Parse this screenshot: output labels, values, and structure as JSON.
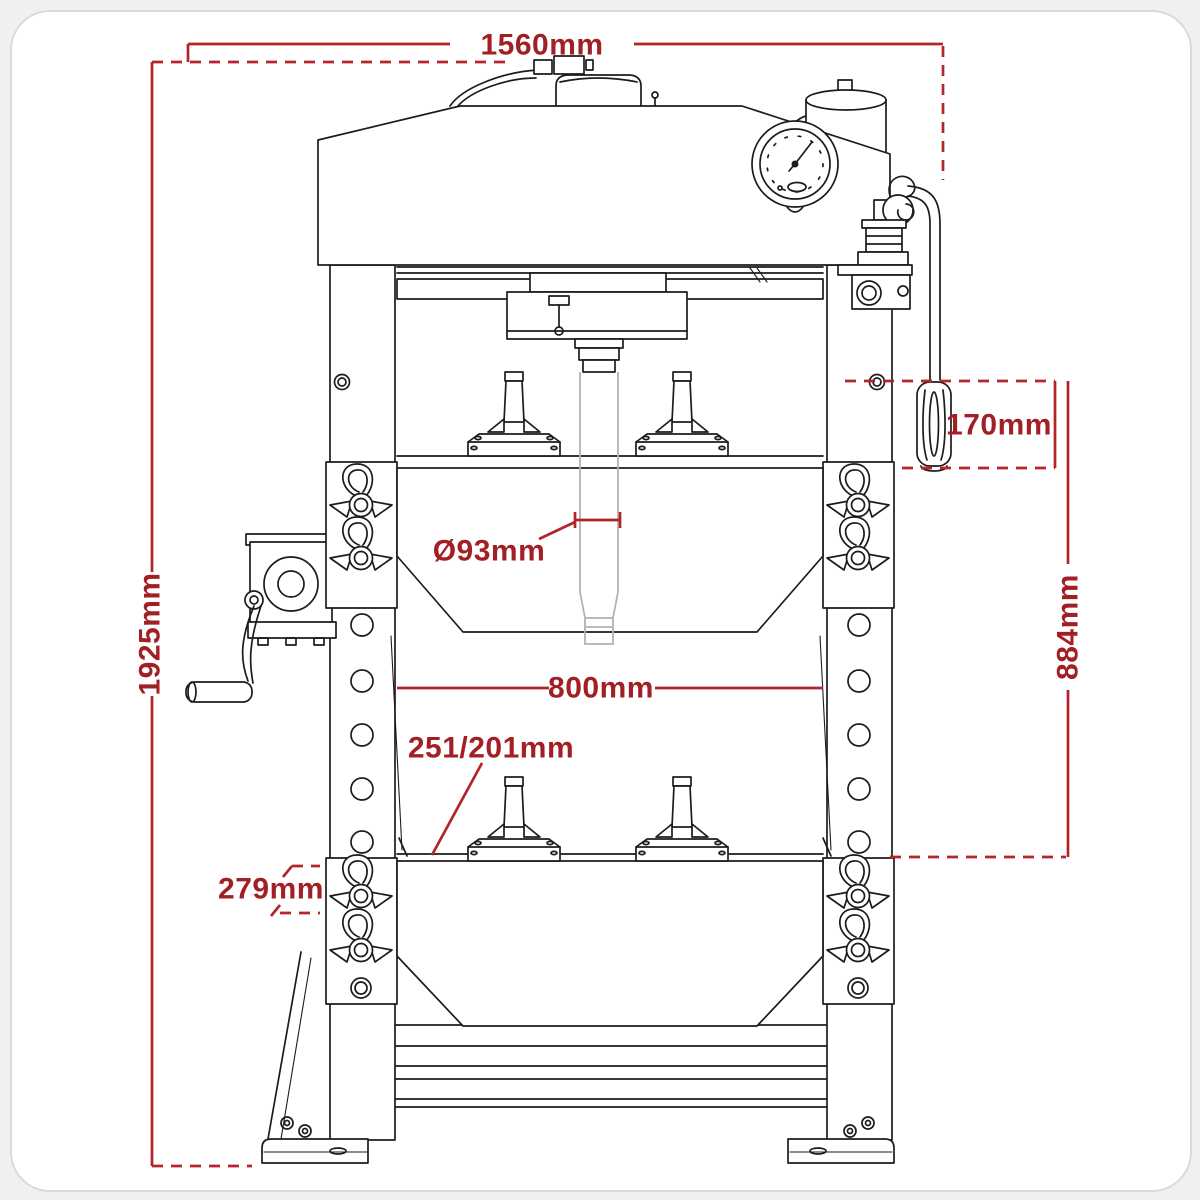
{
  "diagram": {
    "title": "hydraulic-press-front-view-technical-drawing",
    "dimensions": {
      "overall_width": "1560mm",
      "overall_height": "1925mm",
      "handle_length": "170mm",
      "working_height": "884mm",
      "ram_diameter": "Ø93mm",
      "inner_width": "800mm",
      "stroke_range": "251/201mm",
      "bed_depth": "279mm"
    },
    "colors": {
      "dimension_red": "#b1242a",
      "label_red": "#a21f25",
      "line_black": "#1c1c1c",
      "ram_gray": "#b3b3b3",
      "card_background": "#ffffff",
      "page_background": "#f0f0f1"
    }
  }
}
